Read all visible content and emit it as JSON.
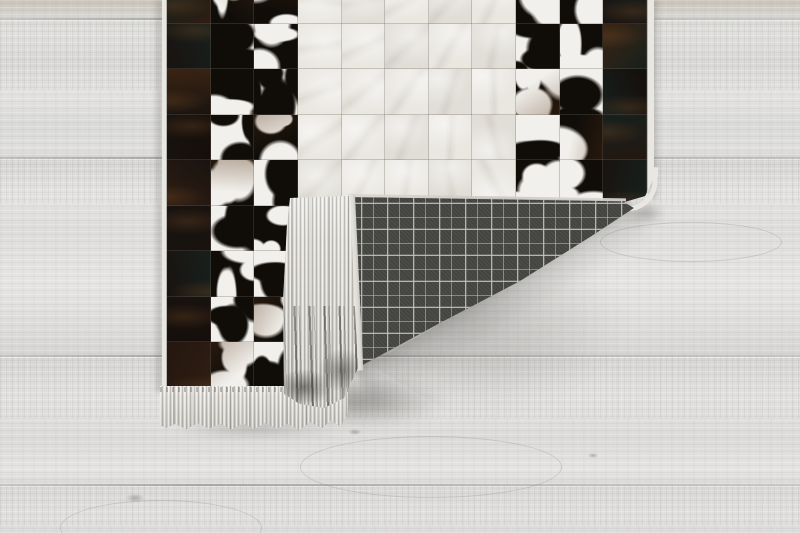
{
  "scene": {
    "description": "Product photograph of a black-and-white cowhide patchwork area rug lying on whitewashed wooden floorboards. The bottom-right corner of the rug is folded over, revealing a grey tartan-plaid woven backing, a white selvage edge and off-white fringe tassels. A second row of fringe runs along the rug's bottom edge. Soft shadows fall on the floor beneath the folded flap.",
    "objects": [
      "area-rug",
      "folded-corner",
      "wood-floor"
    ]
  },
  "floor": {
    "base_color": "#dedddb",
    "top_strip_color": "#c9c3b8",
    "plank_seam_color": "#787672",
    "plank_seam_ys": [
      18,
      157,
      355,
      484
    ]
  },
  "rug": {
    "style": "cowhide patchwork with plaid backing",
    "grid_legend": {
      "D": "dark-hide",
      "B": "spotted-hide-black-dominant",
      "W": "spotted-hide-white-dominant",
      "C": "cream-hide"
    },
    "grid_rows": [
      "DBBCCCCCBBD",
      "DWBCCCCCWBD",
      "DBWCCCCCBWD",
      "DWBCCCCCWBD",
      "DBWCCCCCBBD",
      "DWBCCCCCWBD",
      "DBWCCCCCBWD",
      "DWBCCCCCWBD",
      "DBWCCCCCBWD"
    ],
    "colors": {
      "cream": "#eae7e1",
      "spot_white": "#f2f0ec",
      "spot_black": "#100d09",
      "dark_shades": [
        "#150e0a",
        "#241710",
        "#2e1d12",
        "#191310",
        "#17201d",
        "#3a2413"
      ],
      "binding": "#e9e7e2",
      "fringe": "#dcdad3",
      "plaid_base": "#4a4a47",
      "plaid_line": "#c8c8c6",
      "shadow": "#2d2c2a"
    }
  }
}
